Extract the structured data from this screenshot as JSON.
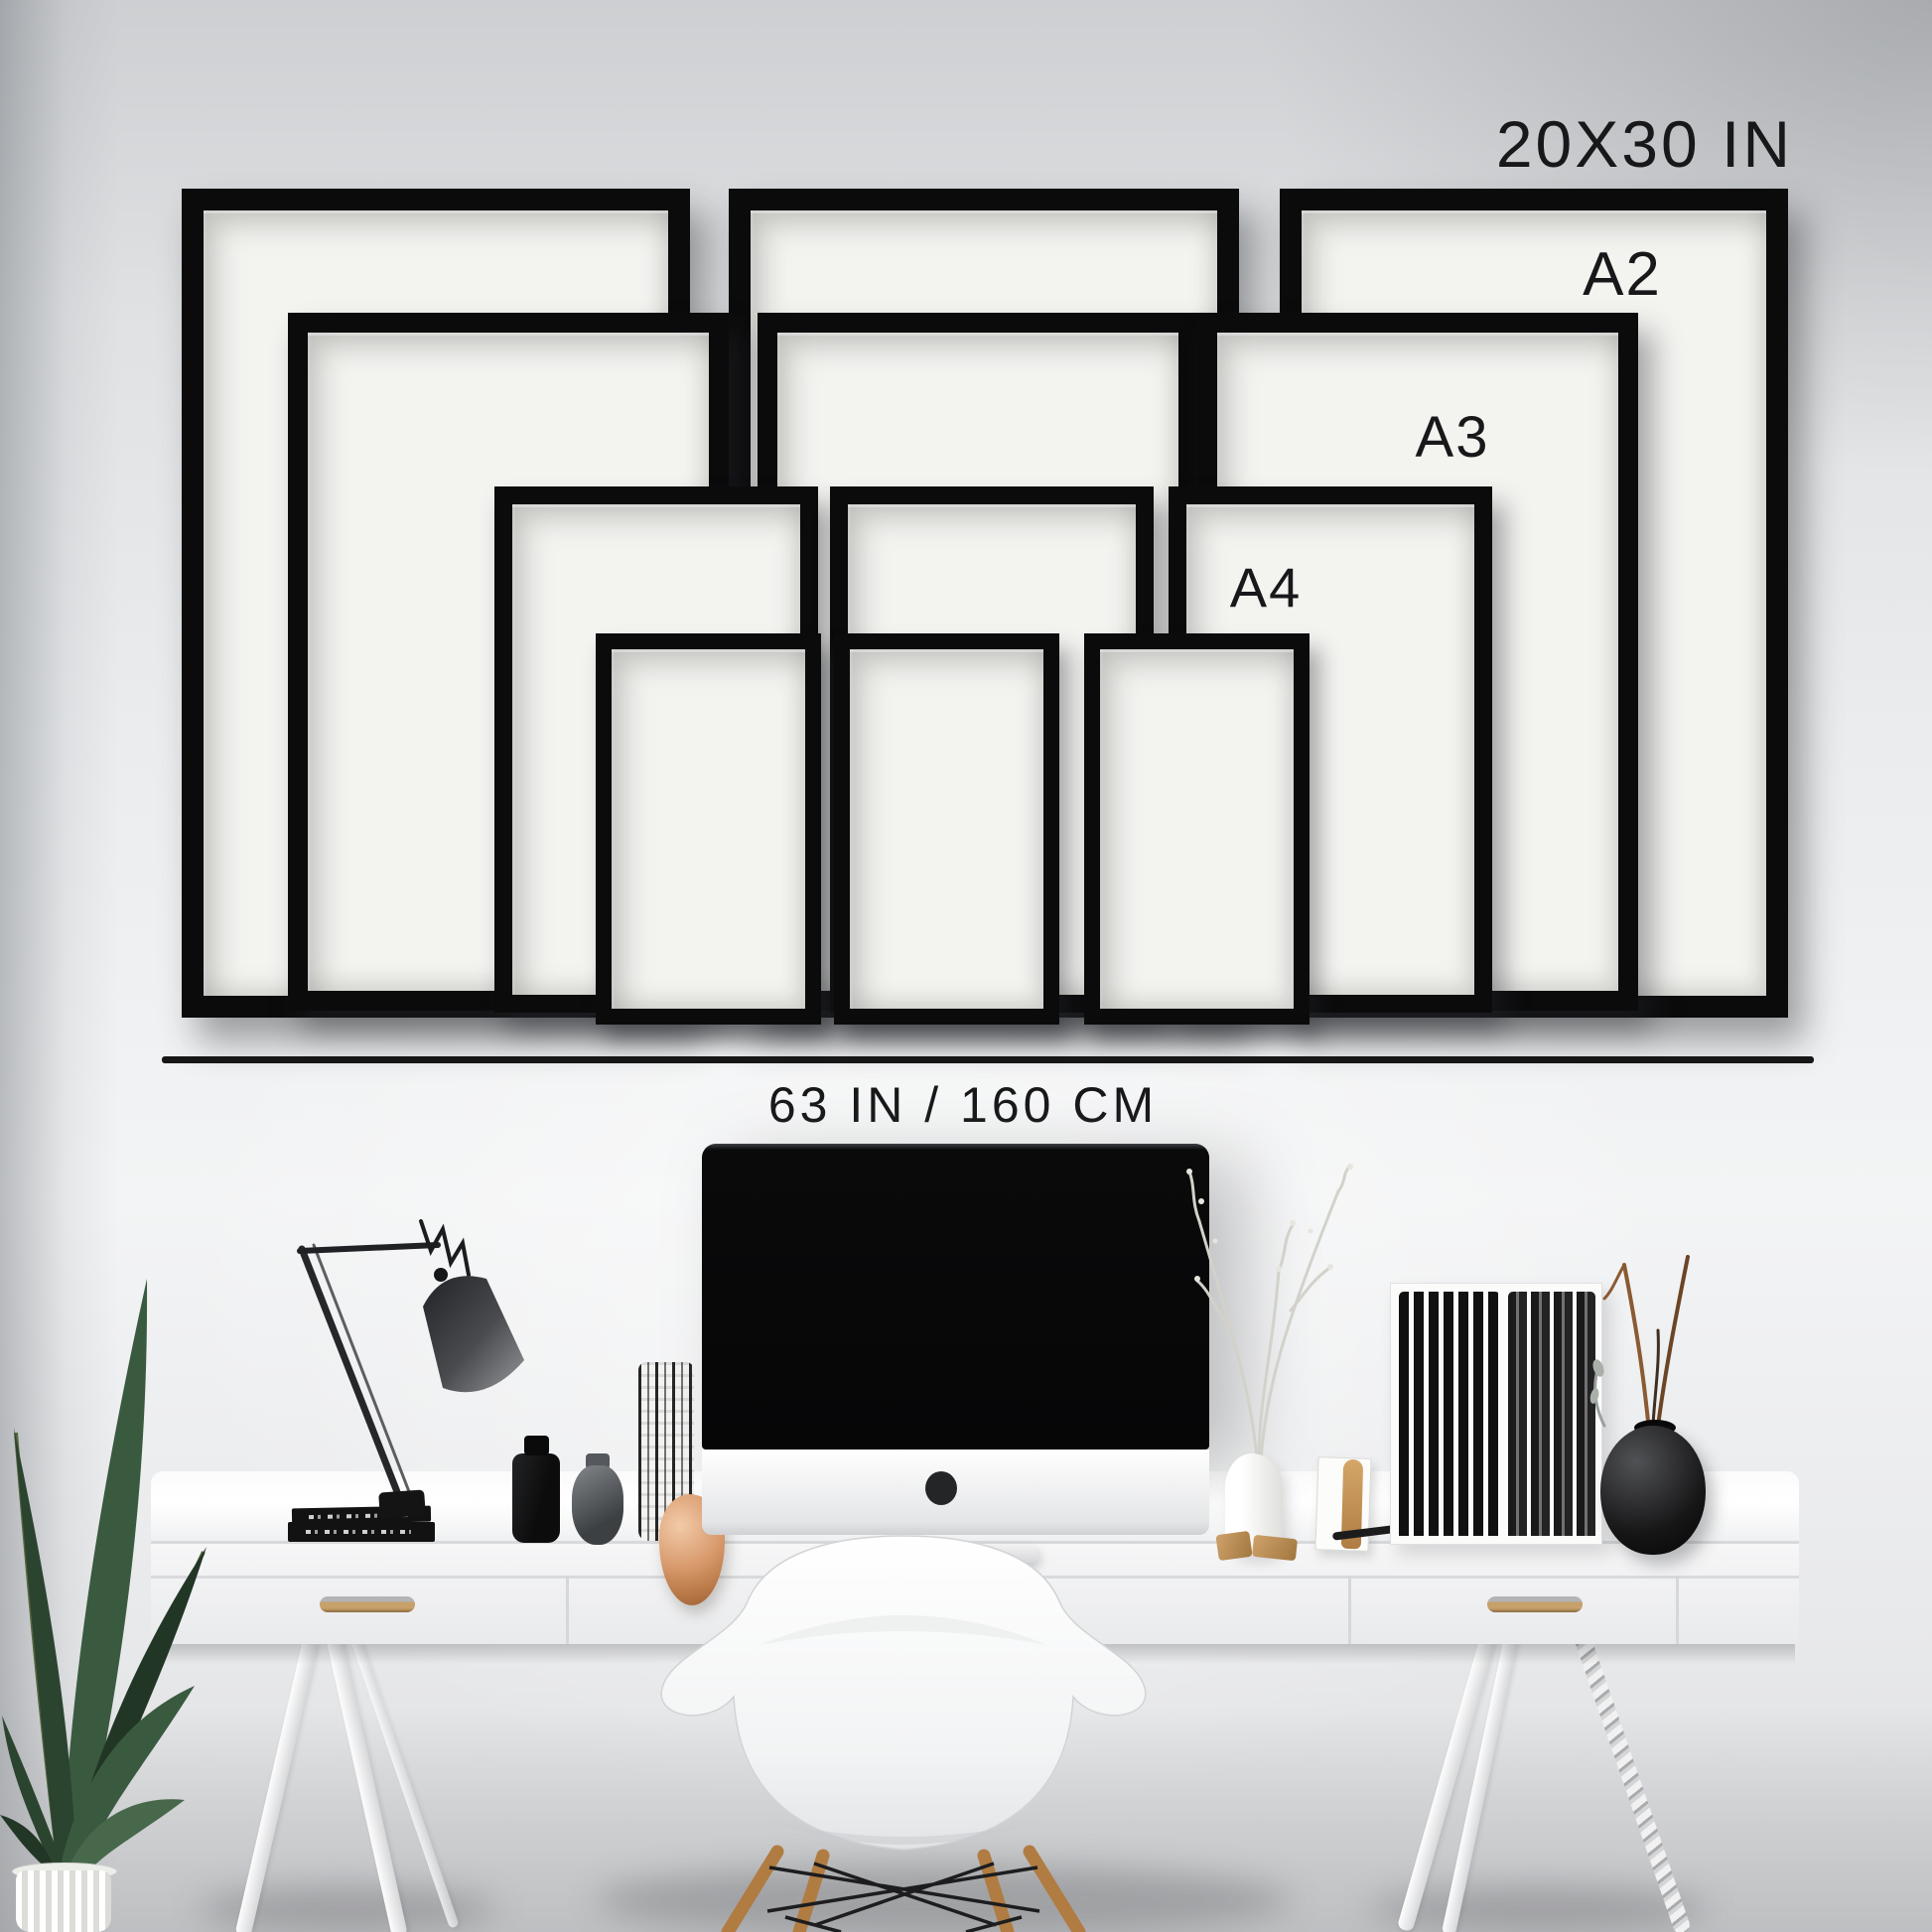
{
  "size_guide": {
    "labels": {
      "largest": "20X30 IN",
      "a2": "A2",
      "a3": "A3",
      "a4": "A4",
      "wall_width": "63 IN / 160 CM"
    },
    "frames": [
      {
        "size": "20X30 IN",
        "column": "left"
      },
      {
        "size": "20X30 IN",
        "column": "middle"
      },
      {
        "size": "20X30 IN",
        "column": "right"
      },
      {
        "size": "A2",
        "column": "left"
      },
      {
        "size": "A2",
        "column": "middle"
      },
      {
        "size": "A2",
        "column": "right"
      },
      {
        "size": "A3",
        "column": "left"
      },
      {
        "size": "A3",
        "column": "middle"
      },
      {
        "size": "A3",
        "column": "right"
      },
      {
        "size": "A4",
        "column": "left"
      },
      {
        "size": "A4",
        "column": "middle"
      },
      {
        "size": "A4",
        "column": "right"
      }
    ],
    "colors": {
      "frame": "#0b0b0c",
      "mat": "#f3f3f0",
      "label_text": "#18181a",
      "divider": "#161617"
    }
  },
  "scene": {
    "wall_color": "#e9eaec",
    "desk_color": "#f7f7f8",
    "wood_color": "#b07c42",
    "plant_color": "#2f4a33",
    "items": [
      "potted-plant",
      "architect-desk-lamp",
      "stacked-books",
      "black-bottle",
      "glass-jar",
      "patterned-pencil-cup",
      "copper-ornament",
      "imac-computer",
      "dried-branches-vase",
      "display-card",
      "copper-pen",
      "black-slat-organizer",
      "round-black-vase",
      "white-desk",
      "white-shell-chair"
    ]
  }
}
